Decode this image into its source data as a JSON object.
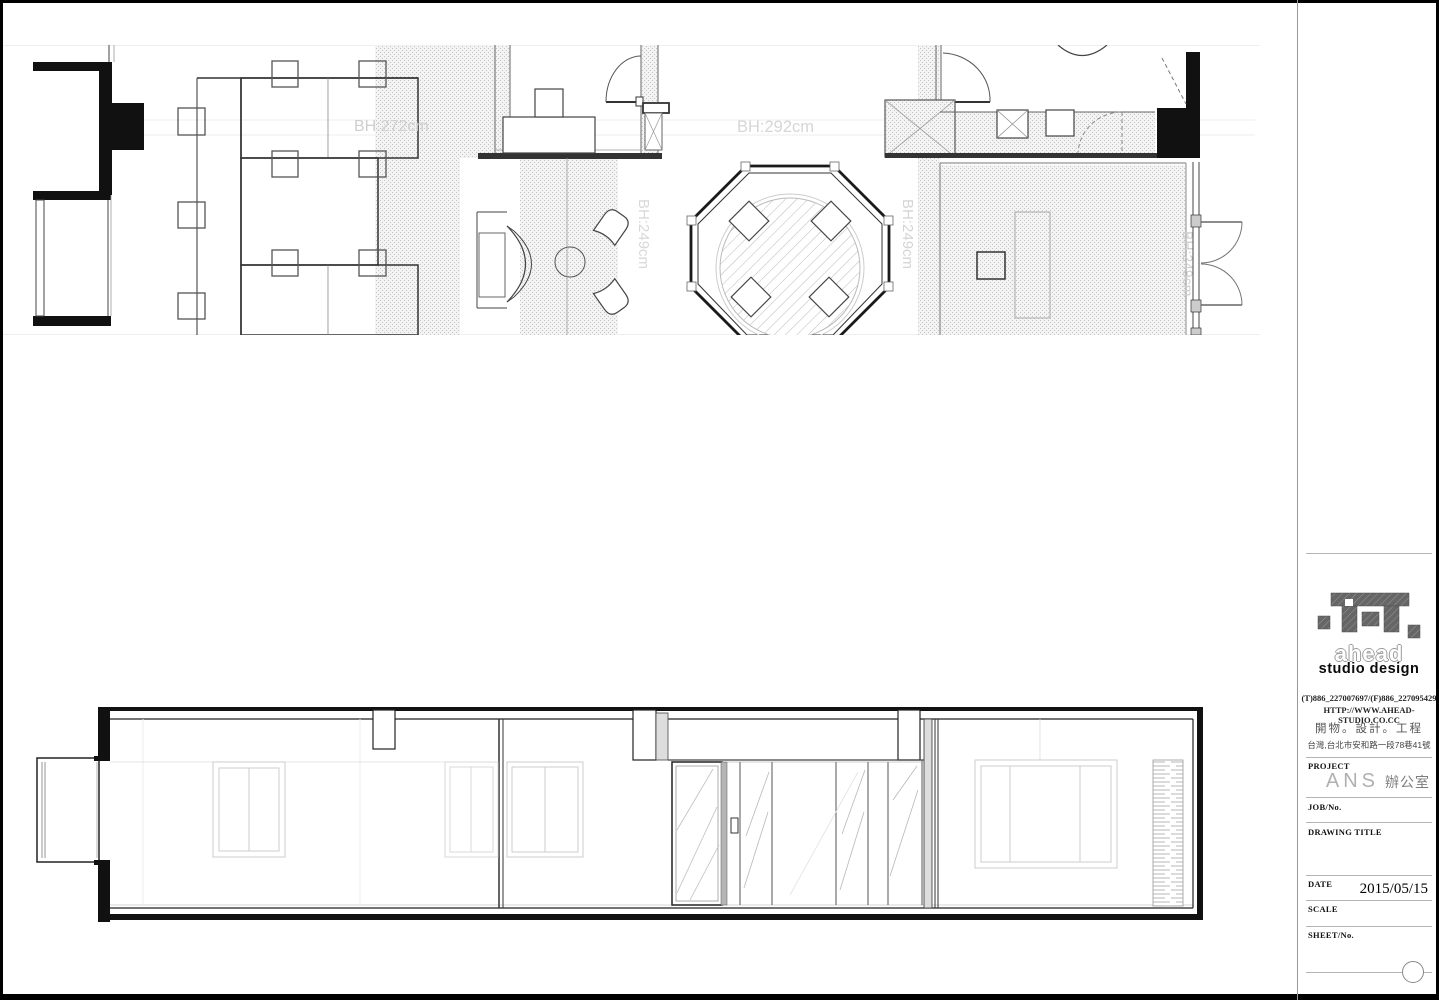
{
  "drawing": {
    "bh_labels": {
      "area1": "BH:272cm",
      "area2": "BH:292cm",
      "area3": "BH:249cm",
      "area4": "BH:249cm",
      "area5": "BH:249cm"
    }
  },
  "title_block": {
    "brand_name": "ahead",
    "brand_sub": "studio design",
    "phone": "(T)886_227007697/(F)886_227095429",
    "website": "HTTP://WWW.AHEAD-STUDIO.CO.CC",
    "services": "開物。設計。工程",
    "address": "台灣,台北市安和路一段78巷41號",
    "project_label": "PROJECT",
    "project_name_en": "ANS",
    "project_name_zh": "辦公室",
    "job_label": "JOB/No.",
    "drawing_title_label": "DRAWING TITLE",
    "date_label": "DATE",
    "date_value": "2015/05/15",
    "scale_label": "SCALE",
    "sheet_label": "SHEET/No."
  }
}
